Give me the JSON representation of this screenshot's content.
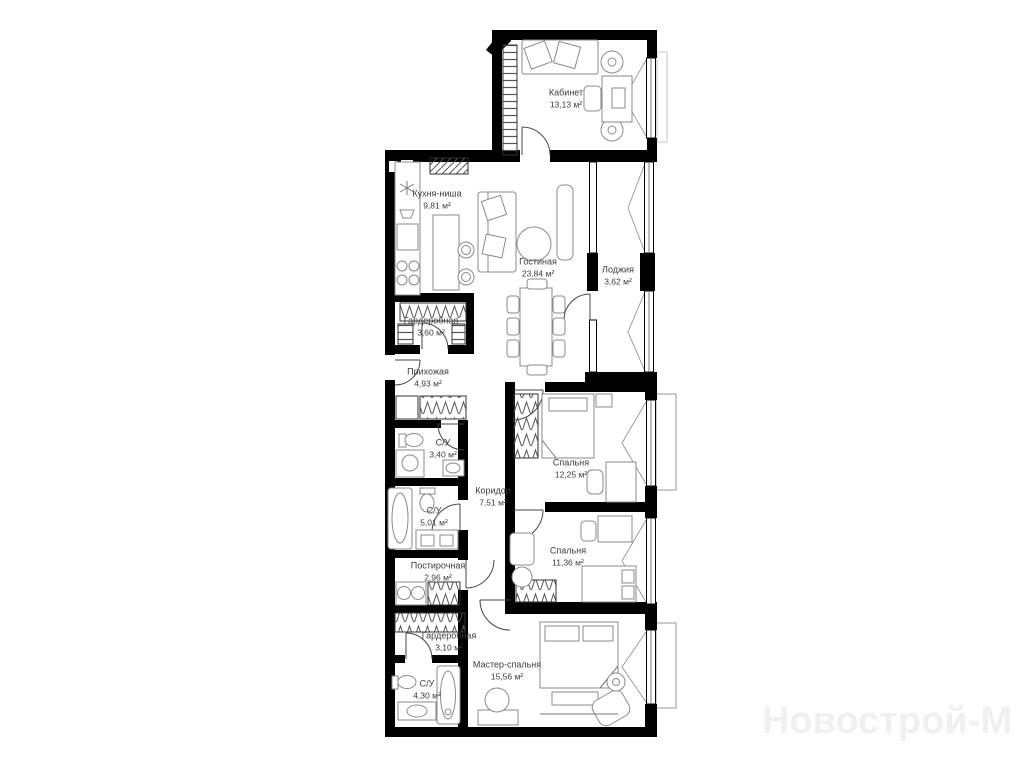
{
  "plan": {
    "watermark": "Новострой-М",
    "area_unit": "м²"
  },
  "rooms": [
    {
      "id": "kabinet",
      "name": "Кабинет",
      "area": "13,13 м²"
    },
    {
      "id": "kitchen",
      "name": "Кухня-ниша",
      "area": "9,81 м²"
    },
    {
      "id": "living",
      "name": "Гостиная",
      "area": "23,84 м²"
    },
    {
      "id": "loggia",
      "name": "Лоджия",
      "area": "3,62 м²"
    },
    {
      "id": "wardrobe-1",
      "name": "Гардеробная",
      "area": "3,60 м²"
    },
    {
      "id": "hallway",
      "name": "Прихожая",
      "area": "4,93 м²"
    },
    {
      "id": "bathroom-1",
      "name": "С/У",
      "area": "3,40 м²"
    },
    {
      "id": "corridor",
      "name": "Коридор",
      "area": "7,51 м²"
    },
    {
      "id": "bedroom-1",
      "name": "Спальня",
      "area": "12,25 м²"
    },
    {
      "id": "bathroom-2",
      "name": "С/У",
      "area": "5,01 м²"
    },
    {
      "id": "bedroom-2",
      "name": "Спальня",
      "area": "11,36 м²"
    },
    {
      "id": "laundry",
      "name": "Постирочная",
      "area": "2,96 м²"
    },
    {
      "id": "wardrobe-2",
      "name": "Гардеробная",
      "area": "3,10 м²"
    },
    {
      "id": "master",
      "name": "Мастер-спальня",
      "area": "15,56 м²"
    },
    {
      "id": "bathroom-3",
      "name": "С/У",
      "area": "4,30 м²"
    }
  ]
}
